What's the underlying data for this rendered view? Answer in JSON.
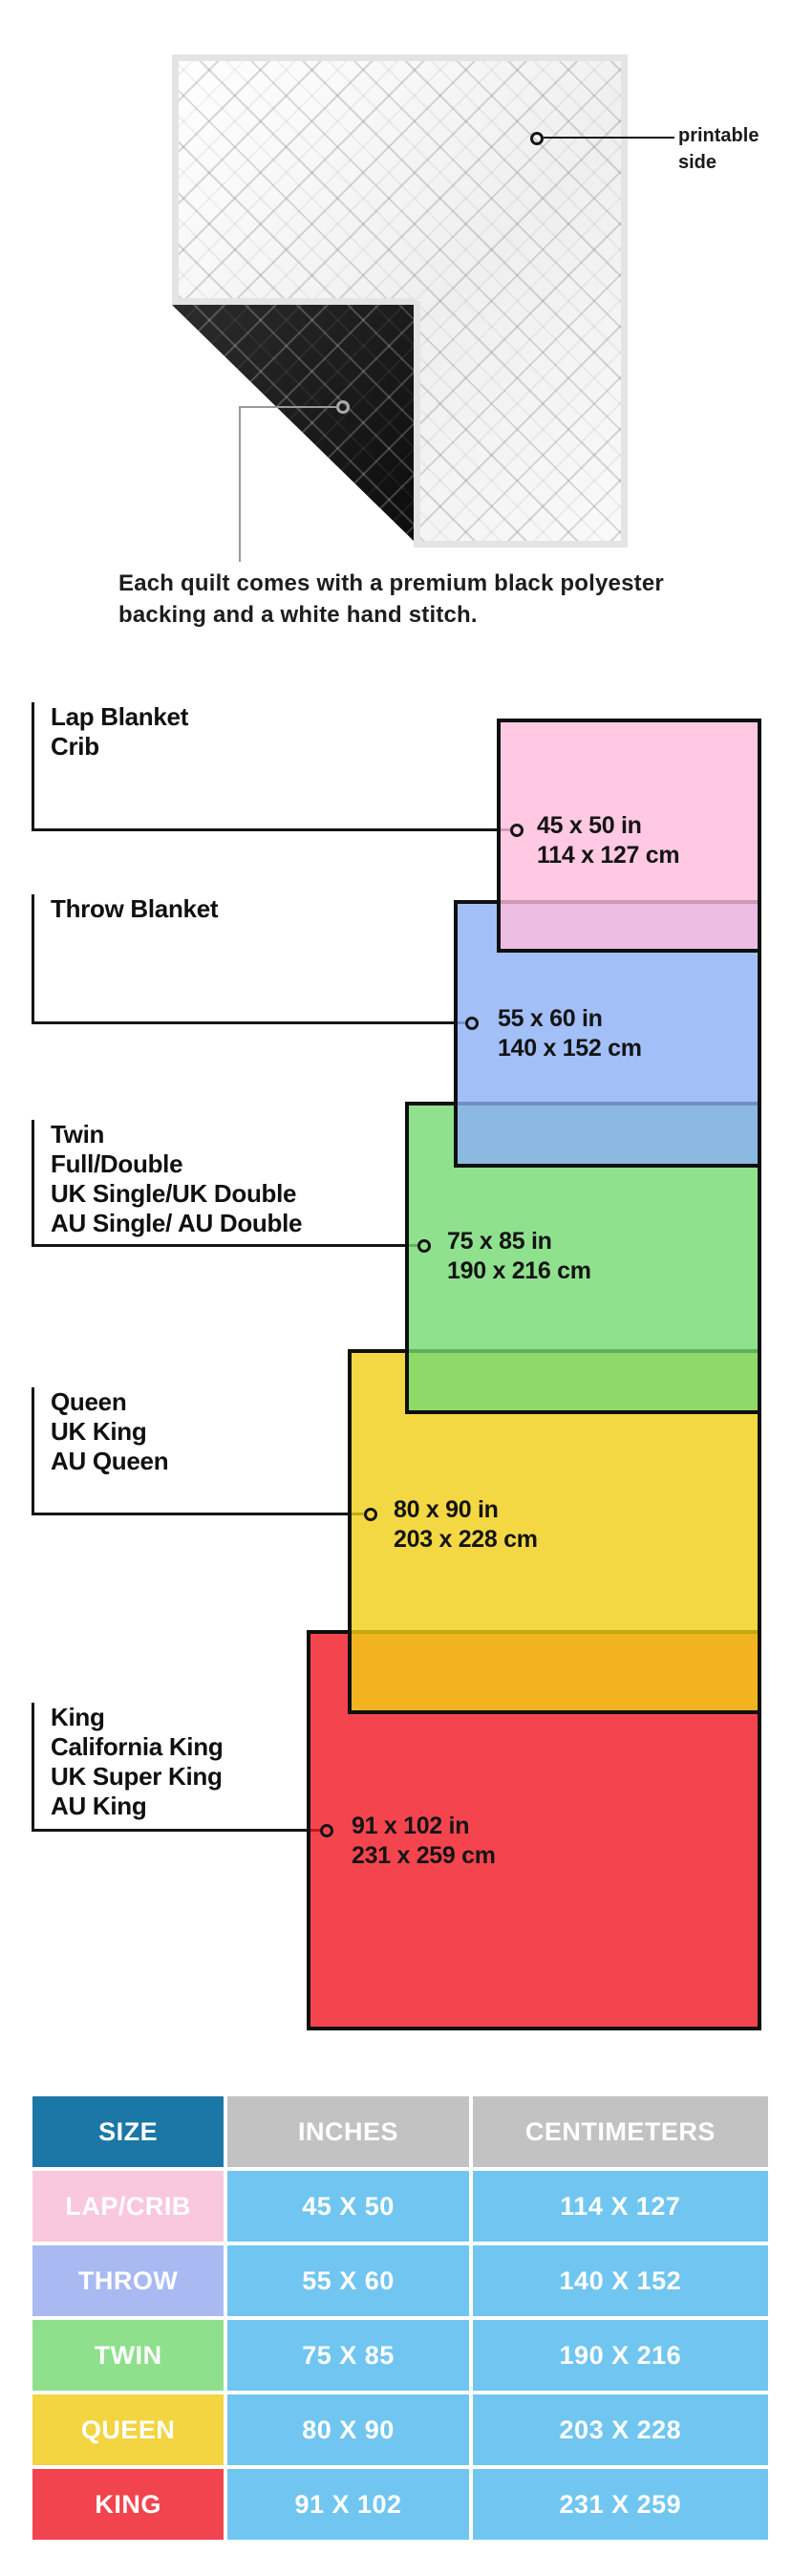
{
  "hero": {
    "printable_side_label": "printable side",
    "caption": "Each quilt comes with a premium black polyester backing and a white hand stitch."
  },
  "diagram": {
    "items": [
      {
        "names": [
          "Lap Blanket",
          "Crib"
        ],
        "size_in": "45 x 50 in",
        "size_cm": "114 x 127 cm",
        "color": "#FFC9E3",
        "fill": "rgba(255,188,220,0.8)"
      },
      {
        "names": [
          "Throw Blanket"
        ],
        "size_in": "55 x 60 in",
        "size_cm": "140 x 152 cm",
        "color": "#A2BFF8",
        "fill": "rgba(139,175,246,0.8)"
      },
      {
        "names": [
          "Twin",
          "Full/Double",
          "UK Single/UK Double",
          "AU Single/ AU Double"
        ],
        "size_in": "75 x 85 in",
        "size_cm": "190 x 216 cm",
        "color": "#90E18E",
        "fill": "rgba(116,217,114,0.8)"
      },
      {
        "names": [
          "Queen",
          "UK King",
          "AU Queen"
        ],
        "size_in": "80 x 90 in",
        "size_cm": "203 x 228 cm",
        "color": "#F4D643",
        "fill": "rgba(241,206,20,0.8)"
      },
      {
        "names": [
          "King",
          "California King",
          "UK Super King",
          "AU King"
        ],
        "size_in": "91 x 102 in",
        "size_cm": "231 x 259 cm",
        "color": "#F4454F",
        "fill": "rgba(241,22,35,0.8)"
      }
    ]
  },
  "table": {
    "headers": [
      "SIZE",
      "INCHES",
      "CENTIMETERS"
    ],
    "colors": {
      "header_size": "#1B77A5",
      "header_measure": "#C2C2C2",
      "cell": "#70C6F0"
    },
    "rows": [
      {
        "size": "LAP/CRIB",
        "inches": "45 X 50",
        "cm": "114 X 127",
        "color": "#F9C8DE"
      },
      {
        "size": "THROW",
        "inches": "55 X 60",
        "cm": "140 X 152",
        "color": "#A9B9F2"
      },
      {
        "size": "TWIN",
        "inches": "75 X 85",
        "cm": "190 X 216",
        "color": "#8FE08D"
      },
      {
        "size": "QUEEN",
        "inches": "80 X 90",
        "cm": "203 X 228",
        "color": "#F3D441"
      },
      {
        "size": "KING",
        "inches": "91 X 102",
        "cm": "231 X 259",
        "color": "#F2444E"
      }
    ]
  }
}
